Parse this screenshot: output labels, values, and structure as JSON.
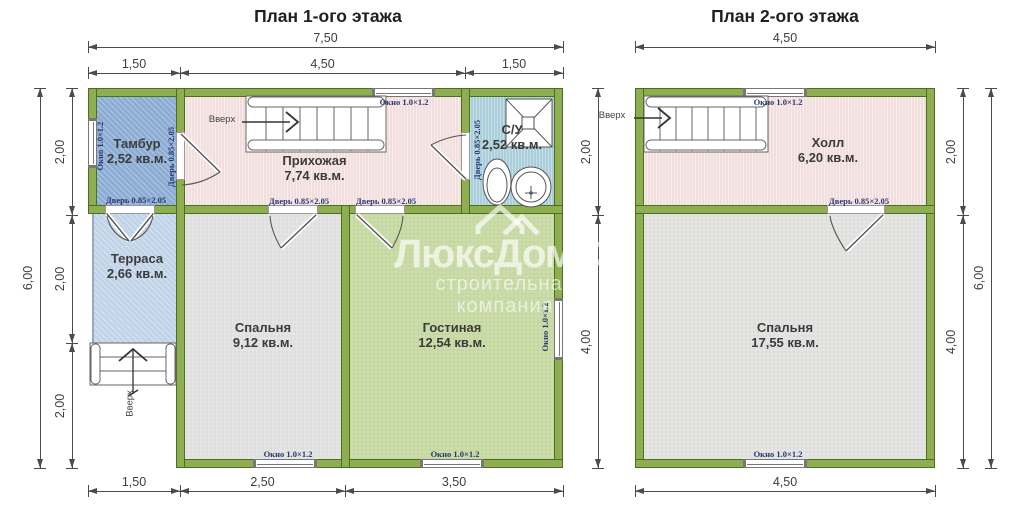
{
  "watermark": {
    "brand": "ЛюксДом53",
    "tagline": "строительная компания"
  },
  "labels": {
    "window": "Окно 1.0×1.2",
    "door": "Дверь 0.85×2.05",
    "up": "Вверх"
  },
  "colors": {
    "wall_fill": "#8fae52",
    "wall_stroke": "#49701d",
    "tambour": "#8cacd4",
    "terrace": "#c0d3e8",
    "bathroom": "#aacfdb",
    "hallway": "#f2dedc",
    "bedroom": "#e4e4e3",
    "living": "#c7d9a2",
    "symbol_label": "#2b3872",
    "dim_text": "#3e3e3e"
  },
  "floor1": {
    "title": "План 1-ого этажа",
    "rooms": [
      {
        "name": "Тамбур",
        "area": "2,52 кв.м."
      },
      {
        "name": "Прихожая",
        "area": "7,74 кв.м."
      },
      {
        "name": "С/У",
        "area": "2,52 кв.м."
      },
      {
        "name": "Терраса",
        "area": "2,66 кв.м."
      },
      {
        "name": "Спальня",
        "area": "9,12 кв.м."
      },
      {
        "name": "Гостиная",
        "area": "12,54 кв.м."
      }
    ],
    "dims": {
      "top_total": "7,50",
      "top_segments": [
        "1,50",
        "4,50",
        "1,50"
      ],
      "left_total": "6,00",
      "left_segments": [
        "2,00",
        "2,00",
        "2,00"
      ],
      "right_segments": [
        "2,00",
        "4,00"
      ],
      "bottom_segments": [
        "1,50",
        "2,50",
        "3,50"
      ]
    }
  },
  "floor2": {
    "title": "План 2-ого этажа",
    "rooms": [
      {
        "name": "Холл",
        "area": "6,20 кв.м."
      },
      {
        "name": "Спальня",
        "area": "17,55 кв.м."
      }
    ],
    "dims": {
      "top_total": "4,50",
      "bottom_total": "4,50",
      "right_segments": [
        "2,00",
        "4,00"
      ],
      "right_total": "6,00"
    }
  }
}
